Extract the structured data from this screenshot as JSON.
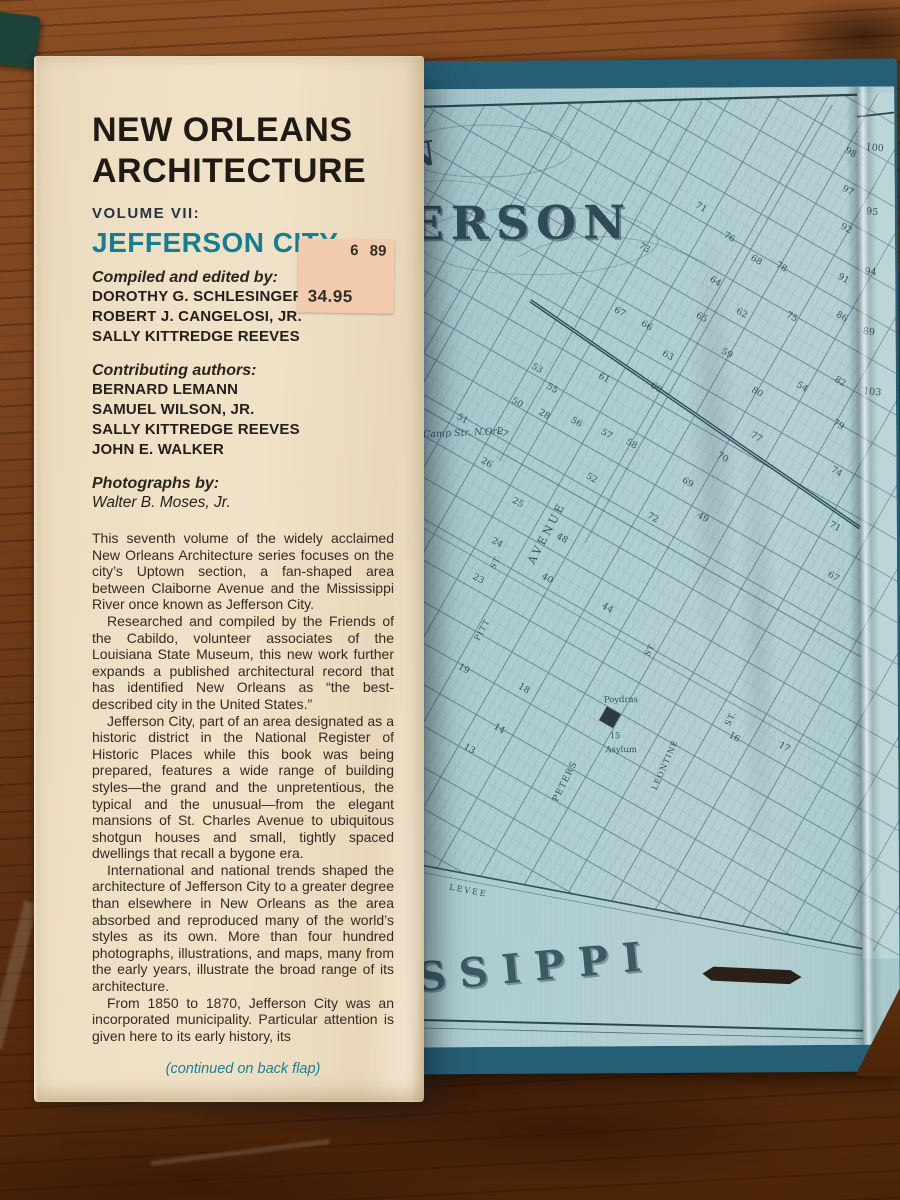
{
  "flap": {
    "title_line1": "NEW ORLEANS",
    "title_line2": "ARCHITECTURE",
    "volume_label": "VOLUME VII:",
    "volume_title": "JEFFERSON CITY",
    "credits": {
      "edited_heading": "Compiled and edited by:",
      "editors": [
        "DOROTHY G. SCHLESINGER",
        "ROBERT J. CANGELOSI, JR.",
        "SALLY KITTREDGE REEVES"
      ],
      "contributing_heading": "Contributing authors:",
      "contributors": [
        "BERNARD LEMANN",
        "SAMUEL WILSON, JR.",
        "SALLY KITTREDGE REEVES",
        "JOHN E. WALKER"
      ],
      "photographs_heading": "Photographs by:",
      "photographer": "Walter B. Moses, Jr."
    },
    "paragraphs": [
      "This seventh volume of the widely acclaimed New Orleans Architecture series focuses on the city’s Uptown section, a fan-shaped area between Claiborne Avenue and the Mississippi River once known as Jefferson City.",
      "Researched and compiled by the Friends of the Cabildo, volunteer associates of the Louisiana State Museum, this new work further expands a published architectural record that has identified New Orleans as “the best-described city in the United States.”",
      "Jefferson City, part of an area designated as a historic district in the National Register of Historic Places while this book was being prepared, features a wide range of building styles—the grand and the unpretentious, the typical and the unusual—from the elegant mansions of St. Charles Avenue to ubiquitous shotgun houses and small, tightly spaced dwellings that recall a bygone era.",
      "International and national trends shaped the architecture of Jefferson City to a greater degree than elsewhere in New Orleans as the area absorbed and reproduced many of the world’s styles as its own. More than four hundred photographs, illustrations, and maps, many from the early years, illustrate the broad range of its architecture.",
      "From 1850 to 1870, Jefferson City was an incorporated municipality. Particular attention is given here to its early history, its"
    ],
    "continued_note": "(continued on back flap)"
  },
  "price_sticker": {
    "date_code": "6 89",
    "price": "34.95"
  },
  "map": {
    "title_fragment_small": "AN",
    "title_fragment_large": "FERSON",
    "label_camp_street": "Camp Str. N.Orl.",
    "label_poydras": "Poydras",
    "label_asylum_number": "15",
    "label_asylum": "Asylum",
    "river_fragment": "SSIPPI",
    "street_labels": [
      {
        "text": "AVENUE",
        "x": 150,
        "y": 446,
        "rot": -62,
        "size": 11,
        "ls": 3
      },
      {
        "text": "ST.",
        "x": 98,
        "y": 474,
        "rot": -62,
        "size": 8,
        "ls": 1
      },
      {
        "text": "ST.",
        "x": 252,
        "y": 562,
        "rot": -63,
        "size": 8,
        "ls": 1
      },
      {
        "text": "PITT",
        "x": 84,
        "y": 542,
        "rot": -61,
        "size": 8,
        "ls": 1
      },
      {
        "text": "PETERS",
        "x": 166,
        "y": 694,
        "rot": -63,
        "size": 9,
        "ls": 1
      },
      {
        "text": "LEONTINE",
        "x": 266,
        "y": 678,
        "rot": -66,
        "size": 8,
        "ls": 1
      },
      {
        "text": "ST.",
        "x": 332,
        "y": 632,
        "rot": -64,
        "size": 8,
        "ls": 1
      },
      {
        "text": "LEVEE",
        "x": 66,
        "y": 804,
        "rot": 11,
        "size": 8,
        "ls": 2
      }
    ],
    "block_numbers": [
      [
        73,
        245,
        162
      ],
      [
        68,
        357,
        175
      ],
      [
        71,
        302,
        122
      ],
      [
        76,
        330,
        152
      ],
      [
        64,
        316,
        196
      ],
      [
        65,
        302,
        232
      ],
      [
        67,
        220,
        226
      ],
      [
        66,
        247,
        240
      ],
      [
        63,
        268,
        270
      ],
      [
        62,
        342,
        228
      ],
      [
        59,
        327,
        268
      ],
      [
        60,
        256,
        302
      ],
      [
        61,
        204,
        292
      ],
      [
        58,
        231,
        358
      ],
      [
        57,
        206,
        348
      ],
      [
        56,
        176,
        336
      ],
      [
        55,
        152,
        302
      ],
      [
        53,
        137,
        282
      ],
      [
        54,
        402,
        302
      ],
      [
        51,
        62,
        332
      ],
      [
        50,
        117,
        316
      ],
      [
        28,
        144,
        328
      ],
      [
        27,
        102,
        346
      ],
      [
        26,
        86,
        376
      ],
      [
        25,
        117,
        416
      ],
      [
        24,
        96,
        456
      ],
      [
        23,
        77,
        492
      ],
      [
        48,
        161,
        452
      ],
      [
        49,
        302,
        432
      ],
      [
        40,
        146,
        492
      ],
      [
        44,
        206,
        522
      ],
      [
        52,
        191,
        392
      ],
      [
        75,
        392,
        232
      ],
      [
        78,
        382,
        182
      ],
      [
        80,
        357,
        307
      ],
      [
        77,
        356,
        352
      ],
      [
        70,
        322,
        372
      ],
      [
        69,
        287,
        397
      ],
      [
        72,
        252,
        432
      ],
      [
        18,
        122,
        602
      ],
      [
        14,
        97,
        642
      ],
      [
        13,
        67,
        662
      ],
      [
        17,
        382,
        662
      ],
      [
        16,
        332,
        652
      ],
      [
        19,
        62,
        582
      ],
      [
        98,
        452,
        68
      ],
      [
        97,
        449,
        106
      ],
      [
        92,
        447,
        144
      ],
      [
        91,
        444,
        194
      ],
      [
        86,
        442,
        232
      ],
      [
        82,
        440,
        297
      ],
      [
        79,
        438,
        340
      ],
      [
        74,
        436,
        387
      ],
      [
        71,
        434,
        442
      ],
      [
        67,
        432,
        492
      ]
    ],
    "fold_numbers": [
      [
        100,
        477,
        64
      ],
      [
        95,
        474,
        128
      ],
      [
        94,
        472,
        188
      ],
      [
        89,
        470,
        248
      ],
      [
        103,
        473,
        308
      ]
    ]
  }
}
